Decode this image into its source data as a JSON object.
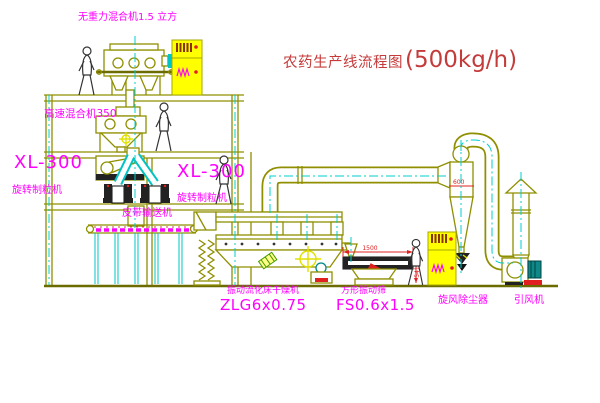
{
  "title": {
    "text": "农药生产线流程图",
    "capacity": "(500kg/h)",
    "color": "#c43b3b"
  },
  "labels": {
    "top_mixer": "无重力混合机1.5 立方",
    "high_speed_mixer": "高速混合机350",
    "granulator_left_model": "XL-300",
    "granulator_left_name": "旋转制粒机",
    "granulator_right_model": "XL-300",
    "granulator_right_name": "旋转制粒机",
    "belt_conveyor": "皮带输送机",
    "dryer_name": "振动流化床干燥机",
    "dryer_model": "ZLG6x0.75",
    "screen_name": "方形振动筛",
    "screen_model": "FS0.6x1.5",
    "cyclone_name": "旋风除尘器",
    "fan_name": "引风机"
  },
  "dimensions": {
    "screen_length": "1500",
    "screen_height": "541",
    "cyclone_dia": "600"
  },
  "colors": {
    "line": "#8f8f00",
    "centerline": "#00cccc",
    "label": "#ff00ff",
    "title": "#c43b3b",
    "dimension": "#e02020",
    "cabinet_fill": "#ffff00",
    "background": "#ffffff"
  }
}
